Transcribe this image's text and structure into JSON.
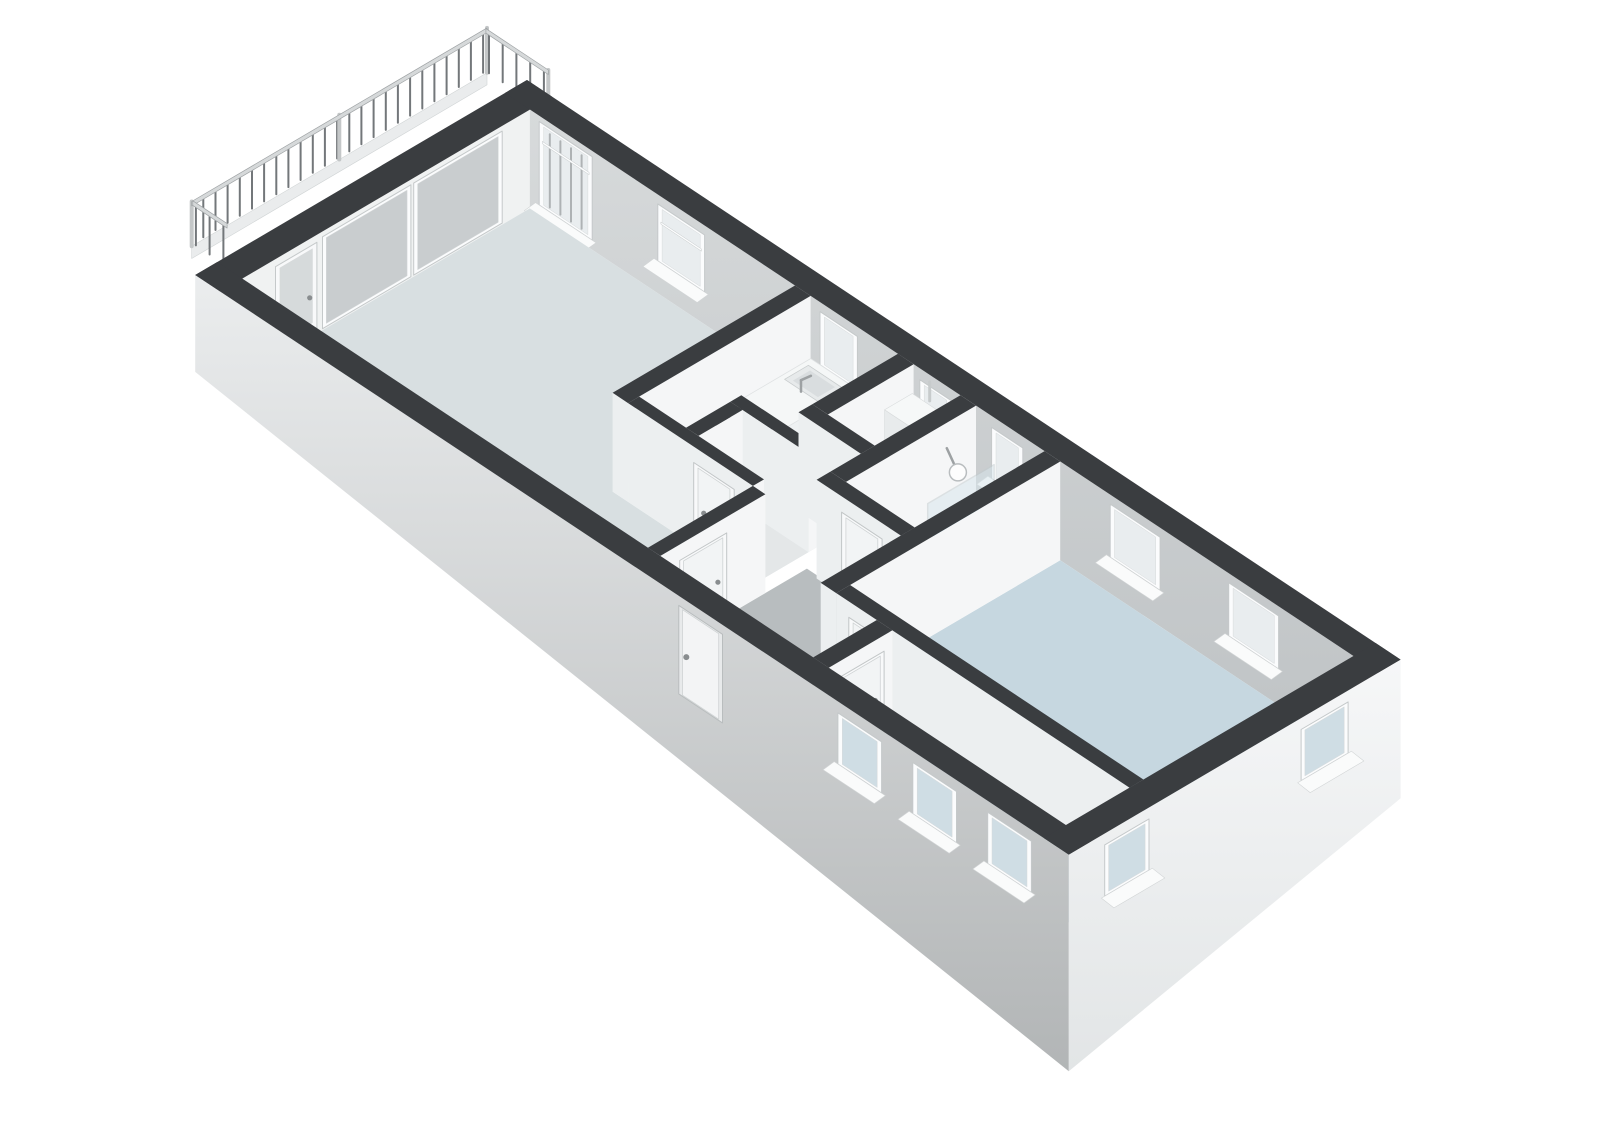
{
  "scene": {
    "name": "3d-floorplan-apartment",
    "background": "#ffffff",
    "projection": {
      "ox": 527,
      "oy": 178.8,
      "ax": 62.4,
      "ay": 41.4,
      "bx": -55.3,
      "by": 32.5,
      "hz": 38,
      "wall_h": 2.6
    },
    "colors": {
      "cap": "#3a3d40",
      "wall_east": "#f5f6f7",
      "wall_south": "#eceff0",
      "nw_interior": "#f0f2f2",
      "ne_top": "#d7dadb",
      "ne_bottom": "#bfc3c5",
      "frame": "#fbfcfd",
      "frame_edge": "#c5c9ca",
      "sill": "#fafbfb",
      "glass_interior": "#e9edef",
      "glass_slider": "#c9cdcf",
      "glass_door": "#d6dadb",
      "glass_exterior": "#cfdde4",
      "floor_living": "#d8dfe1",
      "floor_bedroom": "#c6d7e0",
      "floor_hall": "#b8bdbf",
      "floor_bathroom": "#2f9ec9",
      "floor_service": "#e4e7e8",
      "facade_sw_top": "#ebedee",
      "facade_sw_bottom": "#b2b5b6",
      "facade_se_top": "#f6f7f8",
      "facade_se_bottom": "#e2e5e6",
      "railing_bar": "#73777a",
      "railing_post": "#c4c7c8",
      "railing_rail": "#d6d9da",
      "railing_rail_edge": "#9fa3a5",
      "slab_edge": "#eaeced",
      "counter_top": "#f5f7f7",
      "counter_east": "#eef1f2",
      "counter_south": "#e7eaeb",
      "cooktop": "#2c2f31",
      "burner": "#43474a",
      "burner_edge": "#17191b",
      "sink": "#e7eaeb",
      "sink_inner": "#d9dddf",
      "metal": "#9da1a3",
      "boiler_top": "#f6f8f8",
      "boiler_east": "#eff1f2",
      "boiler_south": "#e8ebec",
      "shower_glass": "#d7e6ec",
      "shower_glass_edge": "#c2cbce",
      "door_frame": "#f8f9fa",
      "door_panel": "#f2f4f5",
      "door_panel_edge": "#cfd3d4",
      "handle": "#898d8f"
    },
    "balcony": {
      "offset": [
        58,
        -42
      ],
      "slab": {
        "u": -1.5,
        "v1": 0.08,
        "v2": 5.42,
        "h1": -0.2,
        "h2": 0.12
      },
      "baluster_step": 0.22,
      "bar_h": [
        0.18,
        1.18
      ],
      "rail_h": [
        1.18,
        1.3
      ],
      "long_side": {
        "u": -1.5,
        "v1": 0.08,
        "v2": 5.42,
        "posts": [
          0.08,
          2.75,
          5.42
        ]
      },
      "ne_return": {
        "v": 0.1,
        "u1": -1.5,
        "u2": -0.5
      },
      "sw_return": {
        "v": 5.4,
        "u1": -1.5,
        "u2": -0.95
      }
    },
    "nw_wall": {
      "face": {
        "v1": 0.4,
        "v2": 5.6
      },
      "panes": [
        [
          2.55,
          4.15
        ],
        [
          0.9,
          2.5
        ]
      ],
      "balcony_door": {
        "v1": 4.25,
        "v2": 5.0,
        "handle_v": 4.38
      }
    },
    "ne_windows": [
      {
        "name": "living-window-tall",
        "u1": 0.55,
        "u2": 1.4,
        "hb": 0.25,
        "ht": 2.45,
        "bars": true,
        "transom": 1.95
      },
      {
        "name": "living-window",
        "u1": 2.45,
        "u2": 3.2,
        "hb": 0.85,
        "ht": 2.35,
        "bars": false,
        "transom": 1.9
      },
      {
        "name": "kitchen-window",
        "u1": 5.05,
        "u2": 5.65,
        "hb": 0.95,
        "ht": 2.35,
        "bars": false,
        "transom": 0
      },
      {
        "name": "closet-window",
        "u1": 6.65,
        "u2": 7.15,
        "hb": 0.95,
        "ht": 2.3,
        "bars": false,
        "transom": 0
      },
      {
        "name": "bathroom-window",
        "u1": 7.8,
        "u2": 8.3,
        "hb": 0.95,
        "ht": 2.3,
        "bars": false,
        "transom": 0
      },
      {
        "name": "bedroom1-window-a",
        "u1": 9.7,
        "u2": 10.5,
        "hb": 0.95,
        "ht": 2.35,
        "bars": false,
        "transom": 0
      },
      {
        "name": "bedroom1-window-b",
        "u1": 11.6,
        "u2": 12.4,
        "hb": 0.95,
        "ht": 2.35,
        "bars": false,
        "transom": 0
      }
    ],
    "floors": [
      {
        "name": "floor-living-room",
        "color": "floor_living",
        "pts": [
          [
            0.4,
            0.4
          ],
          [
            4.65,
            0.4
          ],
          [
            4.65,
            3.7
          ],
          [
            6.9,
            3.7
          ],
          [
            6.9,
            5.6
          ],
          [
            0.4,
            5.6
          ]
        ]
      },
      {
        "name": "floor-kitchen",
        "color": "floor_living",
        "pts": [
          [
            4.9,
            0.4
          ],
          [
            6.9,
            0.4
          ],
          [
            6.9,
            3.5
          ],
          [
            4.9,
            3.5
          ]
        ]
      },
      {
        "name": "floor-closet",
        "color": "floor_service",
        "pts": [
          [
            6.55,
            0.4
          ],
          [
            7.3,
            0.4
          ],
          [
            7.3,
            1.95
          ],
          [
            6.55,
            1.95
          ]
        ]
      },
      {
        "name": "floor-toilet",
        "color": "floor_service",
        "pts": [
          [
            5.85,
            2.7
          ],
          [
            6.9,
            2.7
          ],
          [
            6.9,
            3.5
          ],
          [
            5.85,
            3.5
          ]
        ]
      },
      {
        "name": "floor-bathroom",
        "color": "floor_bathroom",
        "pts": [
          [
            7.55,
            0.4
          ],
          [
            8.65,
            0.4
          ],
          [
            8.65,
            2.75
          ],
          [
            7.55,
            2.75
          ]
        ]
      },
      {
        "name": "floor-hallway",
        "color": "floor_hall",
        "pts": [
          [
            7.1,
            2.95
          ],
          [
            9.55,
            2.95
          ],
          [
            9.55,
            5.6
          ],
          [
            7.1,
            5.6
          ]
        ]
      },
      {
        "name": "floor-bedroom-1",
        "color": "floor_bedroom",
        "pts": [
          [
            8.9,
            0.4
          ],
          [
            13.6,
            0.4
          ],
          [
            13.6,
            4.2
          ],
          [
            8.9,
            4.2
          ]
        ]
      },
      {
        "name": "floor-bedroom-2",
        "color": "floor_bedroom",
        "pts": [
          [
            9.8,
            4.45
          ],
          [
            13.6,
            4.45
          ],
          [
            13.6,
            5.6
          ],
          [
            9.8,
            5.6
          ]
        ]
      }
    ],
    "walls": [
      {
        "name": "kitchen-partition",
        "rect": [
          4.65,
          0.4,
          4.9,
          3.7
        ]
      },
      {
        "name": "toilet-north-wall",
        "rect": [
          5.65,
          2.5,
          6.9,
          2.7
        ]
      },
      {
        "name": "toilet-west-wall",
        "rect": [
          5.65,
          2.7,
          5.85,
          3.5
        ]
      },
      {
        "name": "kitchen-south-wall",
        "rect": [
          4.9,
          3.5,
          6.9,
          3.7
        ],
        "door": {
          "face": "v",
          "a1": 5.95,
          "a2": 6.6,
          "handle": "a1"
        }
      },
      {
        "name": "closet-west-wall",
        "rect": [
          6.3,
          0.4,
          6.55,
          1.95
        ]
      },
      {
        "name": "closet-south-wall",
        "rect": [
          6.3,
          1.95,
          7.3,
          2.2
        ]
      },
      {
        "name": "bathroom-west-wall",
        "rect": [
          7.3,
          0.4,
          7.55,
          2.75
        ]
      },
      {
        "name": "bathroom-south-wall",
        "rect": [
          7.3,
          2.75,
          8.65,
          3.0
        ],
        "door": {
          "face": "v",
          "a1": 7.7,
          "a2": 8.35,
          "handle": "a2"
        }
      },
      {
        "name": "hallway-west-wall",
        "rect": [
          6.9,
          3.7,
          7.1,
          5.6
        ],
        "door": {
          "face": "u",
          "a1": 4.4,
          "a2": 5.25,
          "handle": "a1"
        }
      },
      {
        "name": "bedroom1-west-wall",
        "rect": [
          8.65,
          0.4,
          8.9,
          4.45
        ]
      },
      {
        "name": "bedroom1-south-wall",
        "rect": [
          8.9,
          4.2,
          13.6,
          4.45
        ],
        "door": {
          "face": "v",
          "a1": 9.1,
          "a2": 9.75,
          "handle": "a2"
        }
      },
      {
        "name": "bedroom2-west-wall",
        "rect": [
          9.55,
          4.45,
          9.8,
          5.6
        ],
        "door": {
          "face": "u",
          "a1": 4.6,
          "a2": 5.45,
          "handle": "a1"
        }
      }
    ],
    "fixtures": {
      "counter": {
        "u1": 4.9,
        "v1": 0.4,
        "u2": 5.6,
        "v2": 3.45,
        "h": 0.95
      },
      "cooktop": {
        "u1": 4.98,
        "v1": 1.62,
        "u2": 5.52,
        "v2": 2.28
      },
      "burners": [
        {
          "u": 5.12,
          "v": 1.8,
          "r": 7
        },
        {
          "u": 5.38,
          "v": 1.8,
          "r": 5.5
        },
        {
          "u": 5.12,
          "v": 2.1,
          "r": 5.5
        },
        {
          "u": 5.38,
          "v": 2.1,
          "r": 7
        }
      ],
      "sink": {
        "u1": 4.97,
        "v1": 0.52,
        "u2": 5.53,
        "v2": 0.95,
        "faucet_u": 5.25,
        "faucet_v": 0.97
      },
      "boiler": {
        "u1": 6.6,
        "v1": 0.48,
        "u2": 7.05,
        "v2": 0.98,
        "h": 1.95
      },
      "shower": {
        "glass": {
          "u": 8.15,
          "v1": 0.75,
          "v2": 1.95,
          "h": 2.0
        },
        "niche": {
          "u1": 7.92,
          "v1": 1.7,
          "u2": 8.15,
          "v2": 1.95,
          "h": 0.75
        },
        "head": {
          "arm_from": [
            7.57,
            0.95,
            1.97
          ],
          "arm_to": [
            7.88,
            1.1,
            1.8
          ],
          "r": 8.5
        }
      }
    },
    "sw_facade": {
      "bottom_h": [
        0.05,
        -3.1
      ],
      "windows": [
        {
          "name": "bedroom2-sw-window-a",
          "u1": 10.3,
          "u2": 11.0,
          "hb": 0.95,
          "ht": 2.3
        },
        {
          "name": "bedroom2-sw-window-b",
          "u1": 11.5,
          "u2": 12.2,
          "hb": 0.95,
          "ht": 2.3
        },
        {
          "name": "bedroom2-sw-window-c",
          "u1": 12.7,
          "u2": 13.4,
          "hb": 0.95,
          "ht": 2.3
        }
      ],
      "front_door": {
        "u1": 7.75,
        "u2": 8.45,
        "ht": 2.35,
        "handle_u": 7.87
      }
    },
    "se_facade": {
      "bottom_h": [
        -1.05,
        -3.1
      ],
      "windows": [
        {
          "name": "bedroom1-se-window",
          "v1": 0.95,
          "v2": 1.8,
          "hb": 0.95,
          "ht": 2.3
        },
        {
          "name": "bedroom2-se-window",
          "v1": 4.55,
          "v2": 5.35,
          "hb": 0.95,
          "ht": 2.3
        }
      ]
    }
  }
}
